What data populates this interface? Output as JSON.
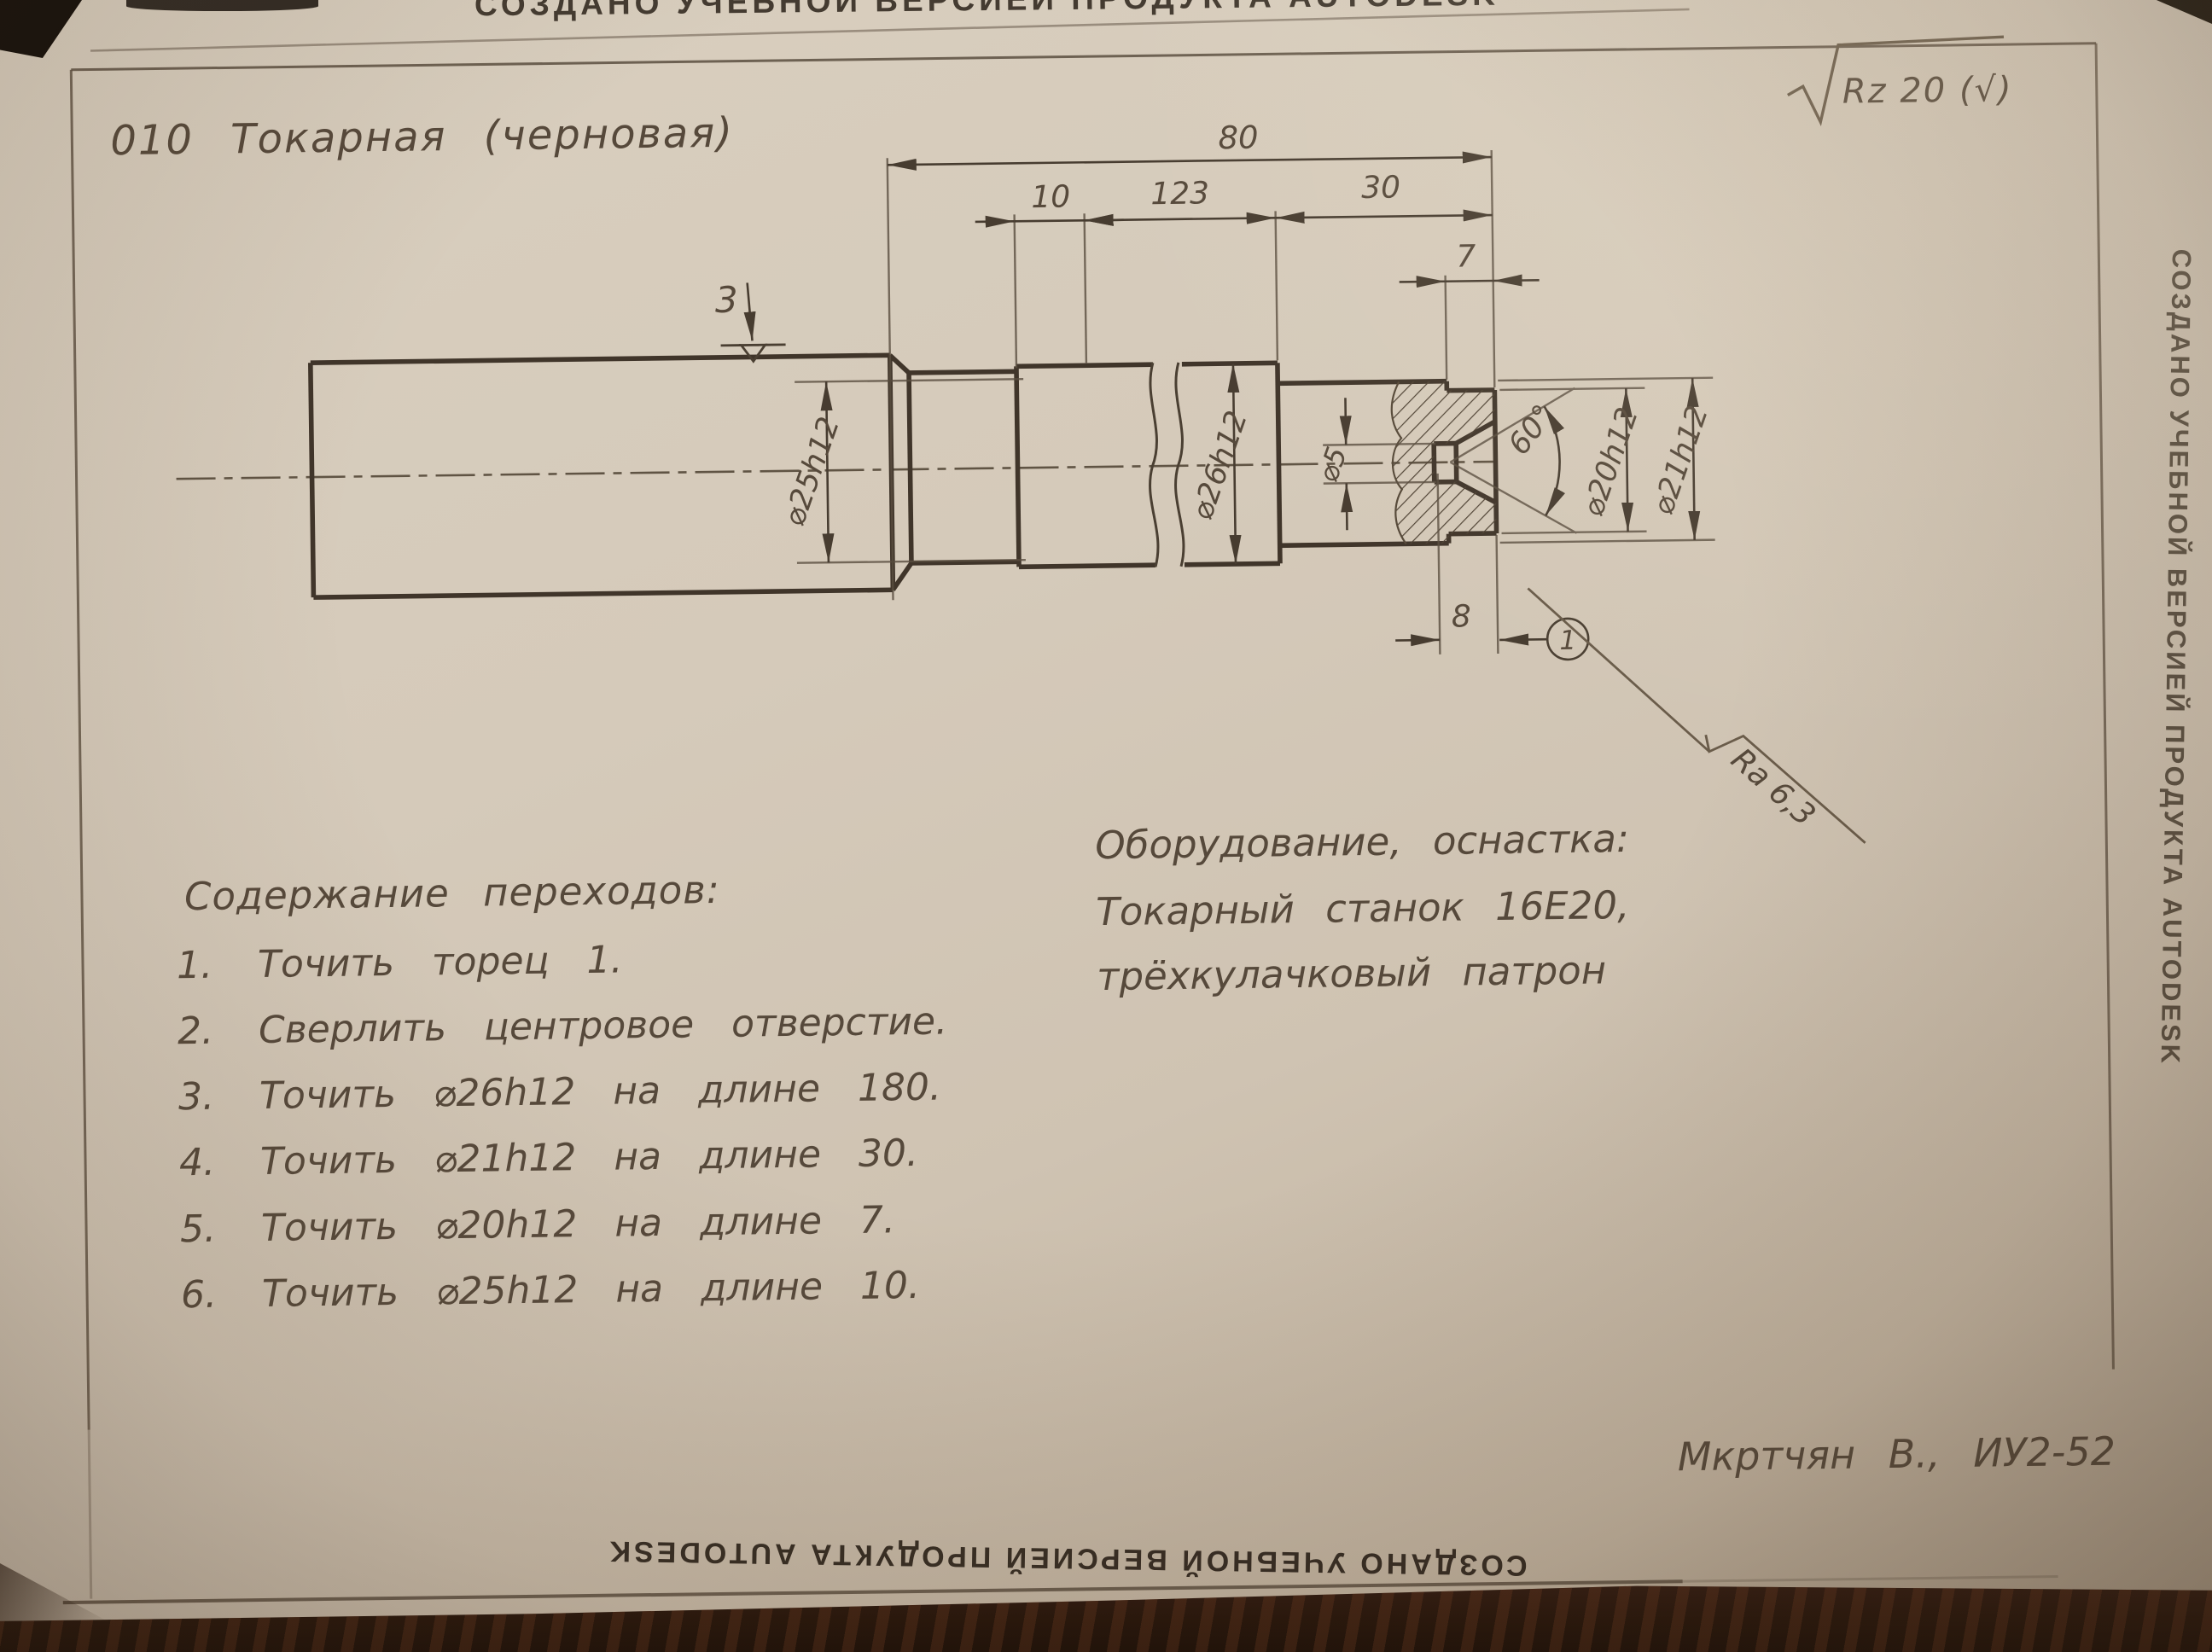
{
  "watermark": {
    "top": "СОЗДАНО УЧЕБНОЙ ВЕРСИЕЙ ПРОДУКТА AUTODESK",
    "bottom": "СОЗДАНО УЧЕБНОЙ ВЕРСИЕЙ ПРОДУКТА AUTODESK",
    "side": "СОЗДАНО УЧЕБНОЙ ВЕРСИЕЙ ПРОДУКТА AUTODESK"
  },
  "operation": {
    "title": "010  Токарная  (черновая)"
  },
  "general_roughness": "Rz 20 (√)",
  "drawing": {
    "dimensions": {
      "overall_length": "80",
      "len_d25": "10",
      "len_d26": "123",
      "len_d21": "30",
      "len_d20": "7",
      "hole_depth": "8"
    },
    "diameters": {
      "d25": "⌀25h12",
      "d26": "⌀26h12",
      "d5": "⌀5",
      "d20": "⌀20h12",
      "d21": "⌀21h12"
    },
    "angle": "60°",
    "surface_mark": "3",
    "surface_1": "1",
    "end_roughness": "Ra 6,3"
  },
  "transitions": {
    "heading": "Содержание переходов:",
    "items": [
      {
        "num": "1.",
        "text": "Точить торец 1."
      },
      {
        "num": "2.",
        "text": "Сверлить центровое отверстие."
      },
      {
        "num": "3.",
        "text": "Точить ⌀26h12 на длине 180."
      },
      {
        "num": "4.",
        "text": "Точить ⌀21h12 на длине 30."
      },
      {
        "num": "5.",
        "text": "Точить ⌀20h12 на длине 7."
      },
      {
        "num": "6.",
        "text": "Точить ⌀25h12 на длине 10."
      }
    ]
  },
  "equipment": {
    "heading": "Оборудование, оснастка:",
    "line1": "Токарный станок 16Е20,",
    "line2": "трёхкулачковый патрон"
  },
  "signature": "Мкртчян В., ИУ2-52"
}
